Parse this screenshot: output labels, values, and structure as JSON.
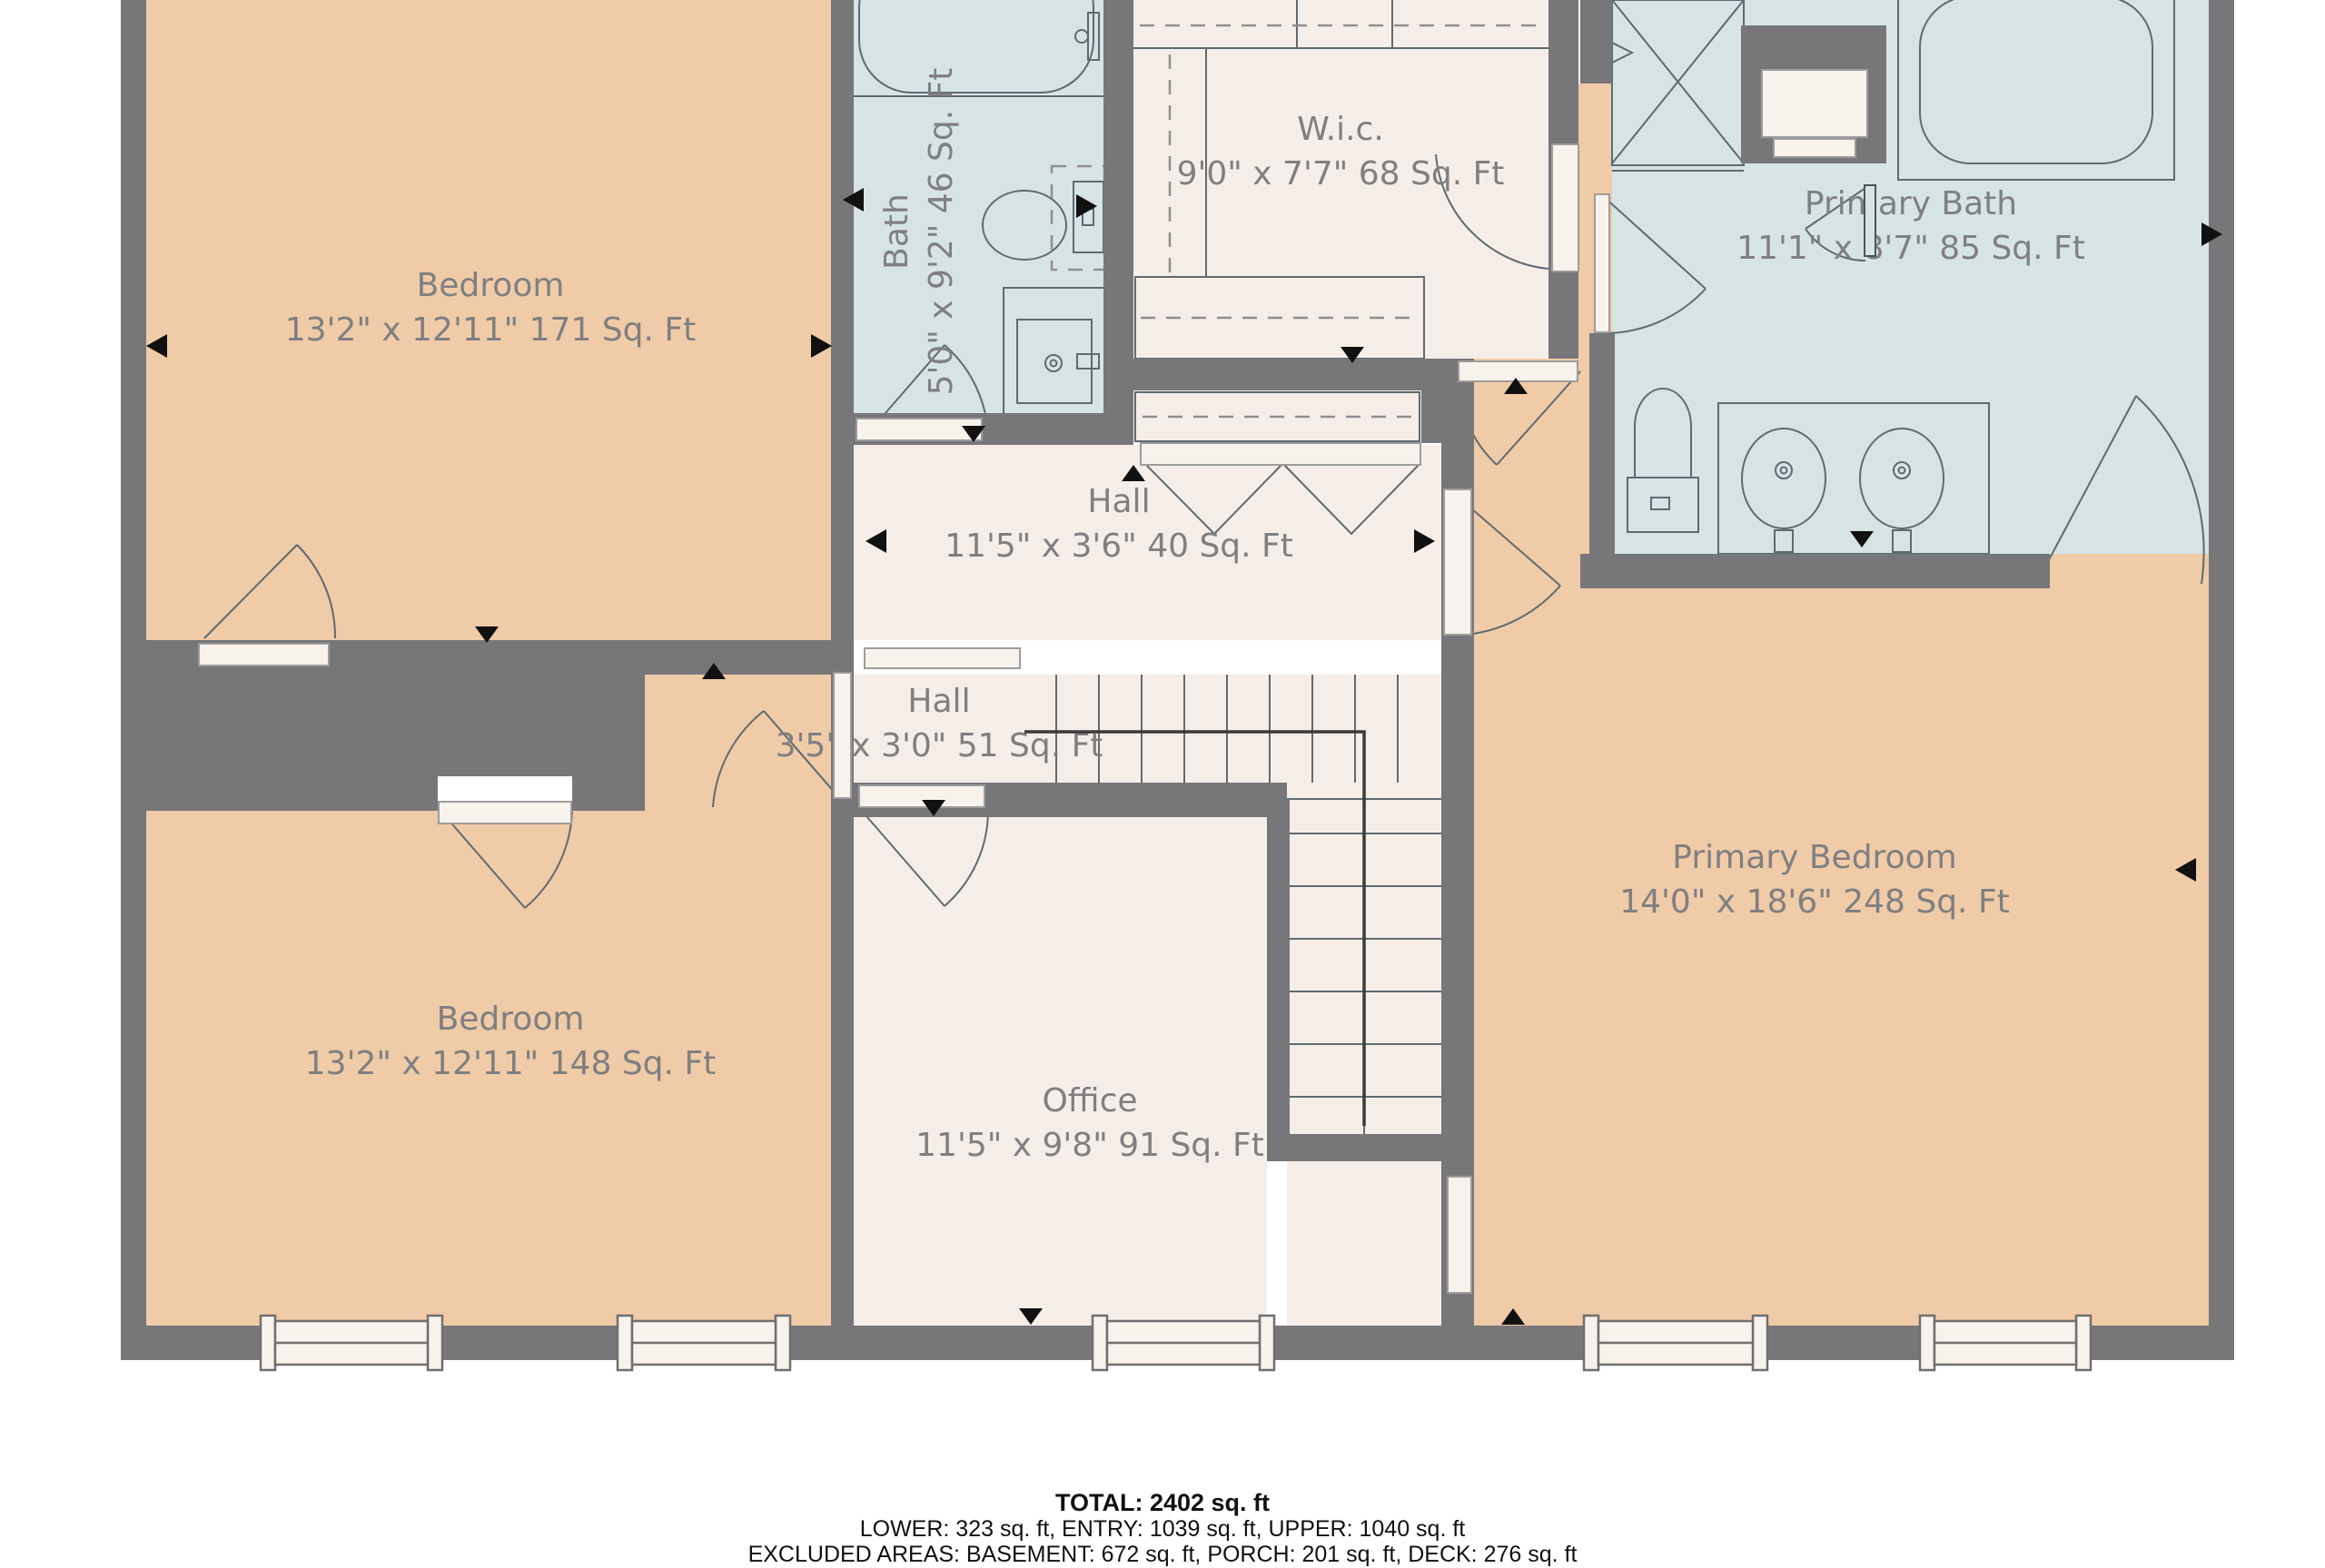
{
  "plan": {
    "rooms": [
      {
        "id": "bedroom1",
        "name": "Bedroom",
        "dims": "13'2\" x 12'11\" 171 Sq. Ft"
      },
      {
        "id": "bath",
        "name": "Bath",
        "dims": "5'0\" x 9'2\" 46 Sq. Ft"
      },
      {
        "id": "wic",
        "name": "W.i.c.",
        "dims": "9'0\" x 7'7\" 68 Sq. Ft"
      },
      {
        "id": "primary_bath",
        "name": "Primary Bath",
        "dims": "11'1\" x 8'7\" 85 Sq. Ft"
      },
      {
        "id": "hall_upper",
        "name": "Hall",
        "dims": "11'5\" x 3'6\" 40 Sq. Ft"
      },
      {
        "id": "hall_lower",
        "name": "Hall",
        "dims": "3'5\" x 3'0\" 51 Sq. Ft"
      },
      {
        "id": "bedroom2",
        "name": "Bedroom",
        "dims": "13'2\" x 12'11\" 148 Sq. Ft"
      },
      {
        "id": "office",
        "name": "Office",
        "dims": "11'5\" x 9'8\" 91 Sq. Ft"
      },
      {
        "id": "primary_bedroom",
        "name": "Primary Bedroom",
        "dims": "14'0\" x 18'6\" 248 Sq. Ft"
      }
    ],
    "summary": {
      "total": "TOTAL: 2402 sq. ft",
      "levels": "LOWER: 323 sq. ft, ENTRY: 1039 sq. ft, UPPER: 1040 sq. ft",
      "excluded": "EXCLUDED AREAS: BASEMENT: 672 sq. ft, PORCH: 201 sq. ft, DECK: 276 sq. ft"
    },
    "colors": {
      "wall": "#77777a",
      "room_tan": "#f0cba7",
      "room_blue": "#d7e4e5",
      "room_cream": "#f5eee8",
      "door_white": "#f8f2ec",
      "label_text": "#7f7f81",
      "fixture_stroke": "#5e6a70",
      "summary_text": "#111111"
    }
  }
}
